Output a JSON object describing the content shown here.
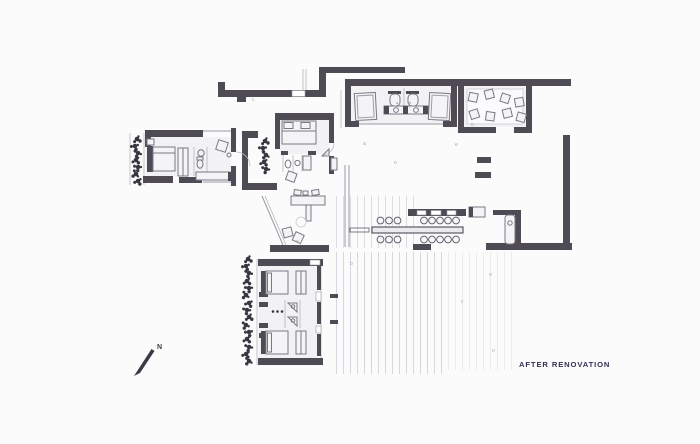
{
  "theme": {
    "bg": "#fbfbfc",
    "wall-color": "#4e4b55",
    "line-color": "#9b99a3",
    "furn-stroke": "#7a7883",
    "furn-fill": "#f4f4f6",
    "plant-color": "#393641",
    "deck-color": "#d7d7de",
    "glyph-color": "#a8a6b0",
    "caption-color": "#343053",
    "north-color": "#3c3947"
  },
  "caption": {
    "label": "AFTER RENOVATION"
  },
  "compass": {
    "label": "N"
  },
  "fixture_labels": [
    "a",
    "b"
  ],
  "tiny_glyphs": [
    "c",
    "a",
    "o",
    "e",
    "o",
    "b",
    "o",
    "c",
    "o",
    "e"
  ]
}
